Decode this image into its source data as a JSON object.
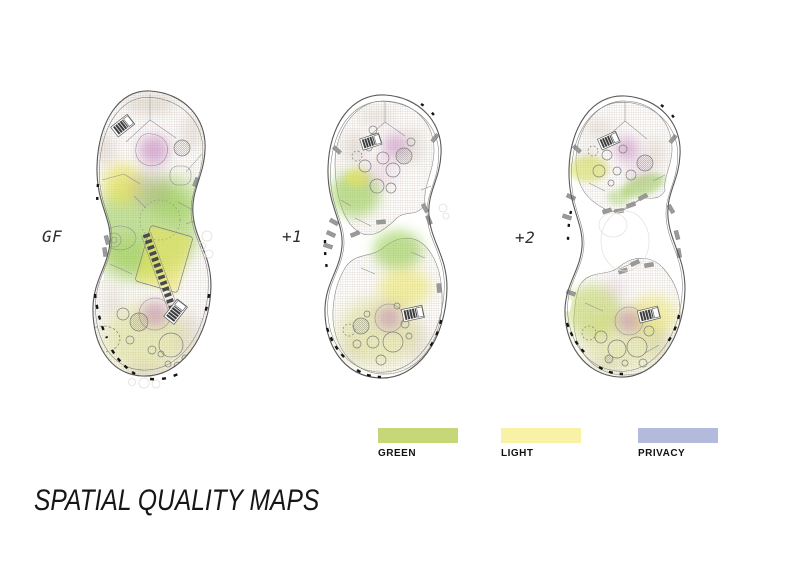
{
  "title": "SPATIAL QUALITY MAPS",
  "floors": [
    {
      "id": "gf",
      "label": "GF"
    },
    {
      "id": "plus1",
      "label": "+1"
    },
    {
      "id": "plus2",
      "label": "+2"
    }
  ],
  "legend": {
    "items": [
      {
        "label": "GREEN",
        "color": "#c6d778"
      },
      {
        "label": "LIGHT",
        "color": "#f7f2a5"
      },
      {
        "label": "PRIVACY",
        "color": "#b4badc"
      }
    ]
  },
  "plan_colors": {
    "green_wash": "#8ec73f",
    "light_wash": "#e9e253",
    "privacy_wash": "#c07ab8",
    "hatch": "#b9a89b",
    "outline": "#595959"
  }
}
